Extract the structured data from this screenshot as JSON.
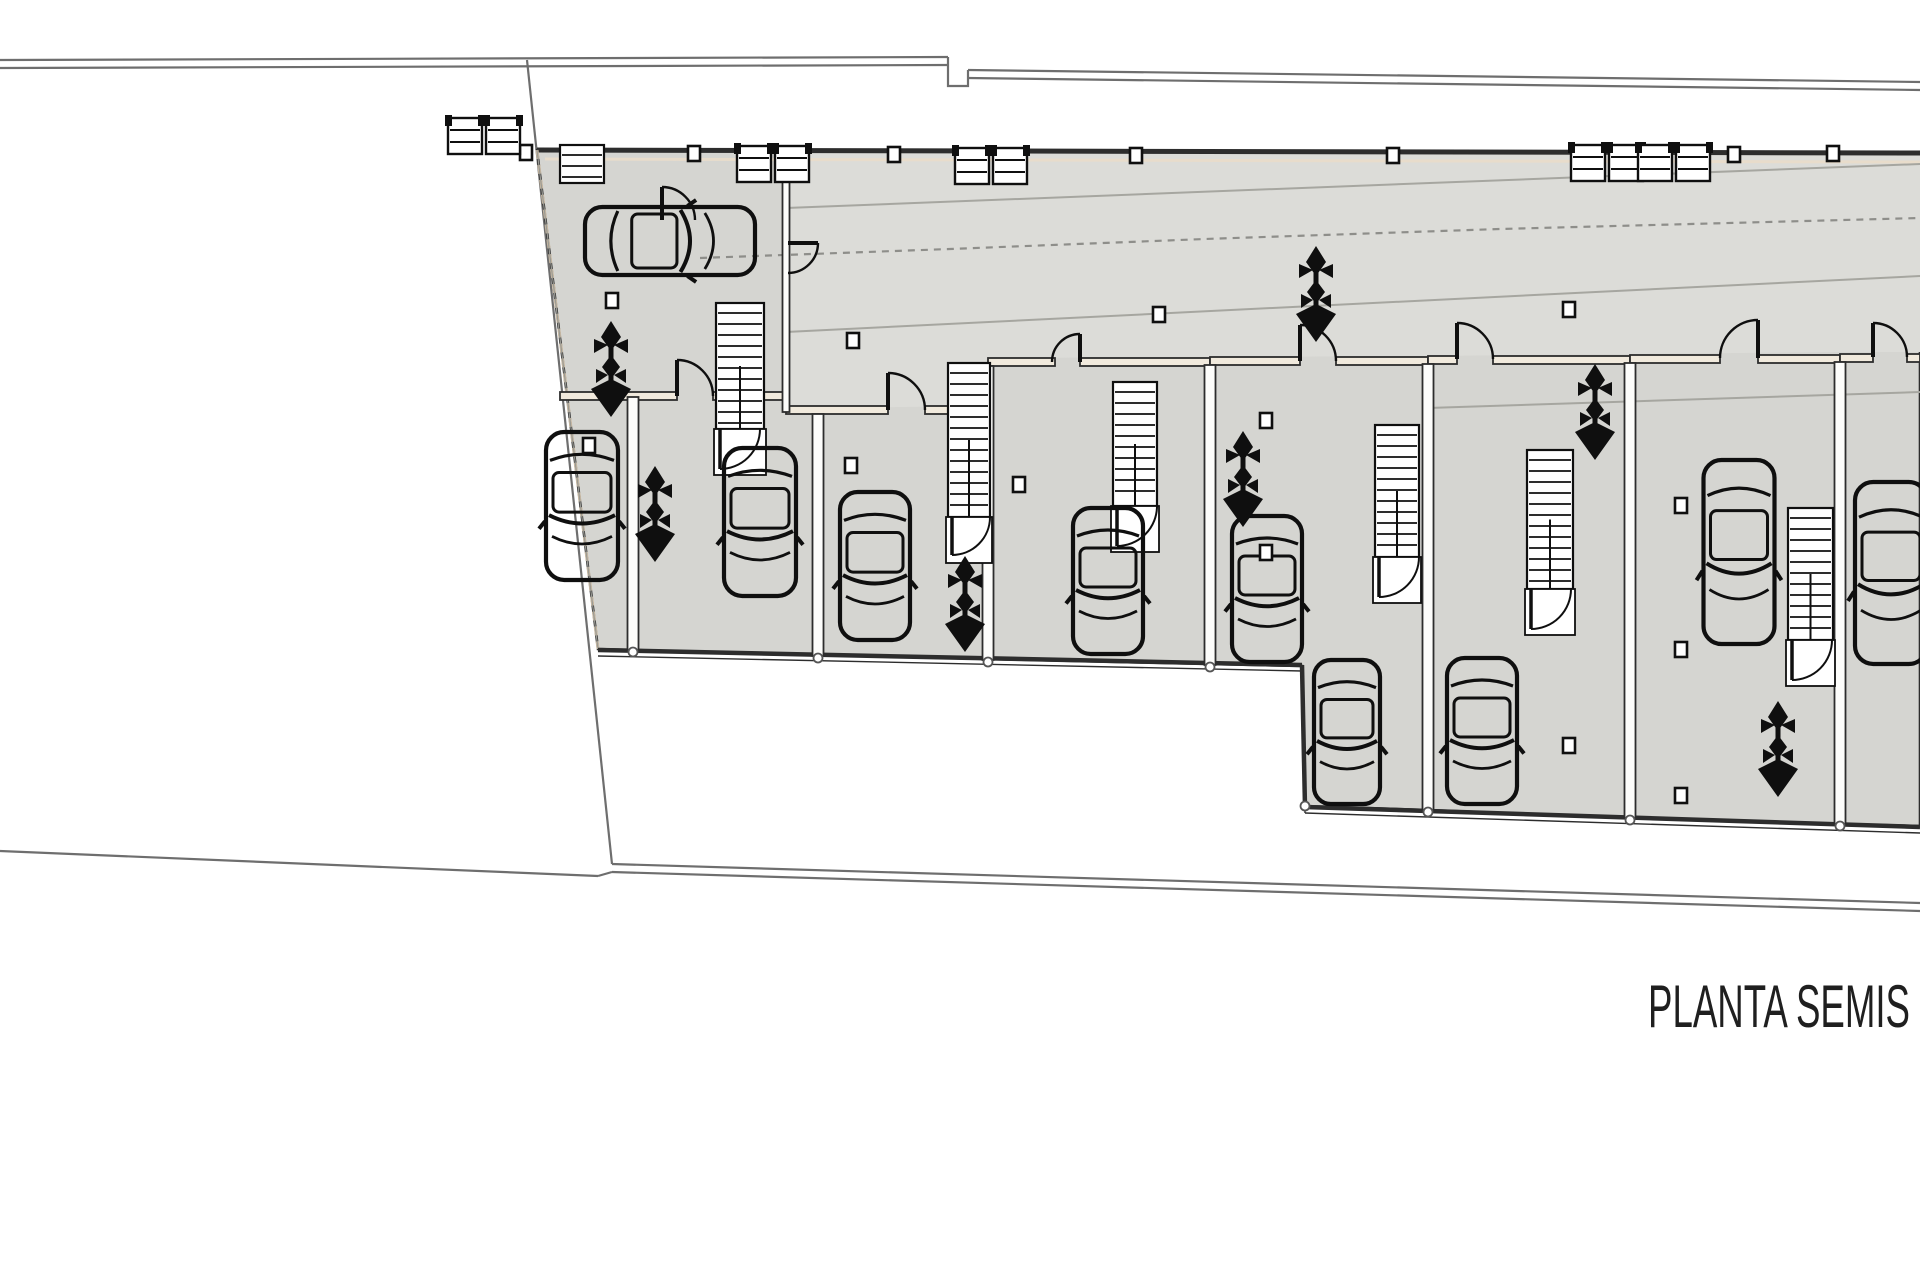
{
  "title": {
    "label": "PLANTA SEMIS",
    "x": 1648,
    "y": 1027,
    "font_size": 60,
    "text_length": 262
  },
  "colors": {
    "paper": "#ffffff",
    "floor": "#d5d5d1",
    "ramp_floor": "#dcdcd8",
    "wall_dark": "#2d2d2d",
    "symbol_ink": "#0f0f0f",
    "boundary": "#6e6e6e",
    "accent_beige": "#e8dccb",
    "wall_fill": "#f1eadd",
    "partition_fill": "#fdfdfb",
    "slope_line": "#a6a6a0",
    "dash_path": "#8e8e8a"
  },
  "site": {
    "lines": [
      {
        "name": "top-boundary-outer",
        "pts": [
          [
            0,
            60
          ],
          [
            948,
            57
          ]
        ]
      },
      {
        "name": "top-boundary-inner",
        "pts": [
          [
            0,
            68
          ],
          [
            948,
            65
          ]
        ]
      },
      {
        "name": "top-boundary-notch",
        "pts": [
          [
            948,
            57
          ],
          [
            948,
            86
          ],
          [
            968,
            86
          ],
          [
            968,
            70
          ]
        ]
      },
      {
        "name": "top-boundary-right-outer",
        "pts": [
          [
            968,
            70
          ],
          [
            1920,
            82
          ]
        ]
      },
      {
        "name": "top-boundary-right-inner",
        "pts": [
          [
            968,
            78
          ],
          [
            1920,
            90
          ]
        ]
      },
      {
        "name": "west-diagonal-boundary",
        "pts": [
          [
            527,
            60
          ],
          [
            612,
            864
          ]
        ]
      },
      {
        "name": "south-boundary-left",
        "pts": [
          [
            0,
            851
          ],
          [
            598,
            876
          ]
        ]
      },
      {
        "name": "south-boundary-jog",
        "pts": [
          [
            598,
            876
          ],
          [
            612,
            872
          ]
        ]
      },
      {
        "name": "south-boundary-right-outer",
        "pts": [
          [
            612,
            864
          ],
          [
            1920,
            903
          ]
        ]
      },
      {
        "name": "south-boundary-right-inner",
        "pts": [
          [
            612,
            872
          ],
          [
            1920,
            911
          ]
        ]
      }
    ]
  },
  "building": {
    "outline": [
      [
        537,
        150
      ],
      [
        1920,
        153
      ],
      [
        1920,
        826
      ],
      [
        1840,
        824
      ],
      [
        1630,
        818
      ],
      [
        1428,
        810
      ],
      [
        1305,
        806
      ],
      [
        1302,
        666
      ],
      [
        1210,
        664
      ],
      [
        988,
        659
      ],
      [
        818,
        655
      ],
      [
        633,
        650
      ],
      [
        598,
        649
      ]
    ],
    "ramp_area": [
      [
        786,
        153
      ],
      [
        1920,
        155
      ],
      [
        1920,
        352
      ],
      [
        1840,
        352
      ],
      [
        1630,
        354
      ],
      [
        1428,
        356
      ],
      [
        1210,
        357
      ],
      [
        988,
        358
      ],
      [
        988,
        406
      ],
      [
        818,
        408
      ],
      [
        786,
        410
      ]
    ],
    "top_wall": [
      [
        537,
        150
      ],
      [
        1920,
        153
      ]
    ],
    "top_wall_accent": [
      [
        545,
        159
      ],
      [
        1920,
        162
      ]
    ],
    "left_edge_dashed": [
      [
        537,
        150
      ],
      [
        598,
        649
      ]
    ],
    "bottom_walls": [
      {
        "pts": [
          [
            598,
            650
          ],
          [
            1302,
            665
          ]
        ]
      },
      {
        "pts": [
          [
            1302,
            665
          ],
          [
            1305,
            807
          ]
        ]
      },
      {
        "pts": [
          [
            1305,
            807
          ],
          [
            1920,
            827
          ]
        ]
      }
    ]
  },
  "walls": {
    "front_segments": [
      {
        "x": 560,
        "y": 392,
        "len": 117
      },
      {
        "x": 713,
        "y": 392,
        "len": 73
      },
      {
        "x": 786,
        "y": 406,
        "len": 102
      },
      {
        "x": 925,
        "y": 406,
        "len": 63
      },
      {
        "x": 988,
        "y": 358,
        "len": 67
      },
      {
        "x": 1080,
        "y": 358,
        "len": 130
      },
      {
        "x": 1210,
        "y": 357,
        "len": 90
      },
      {
        "x": 1336,
        "y": 357,
        "len": 92
      },
      {
        "x": 1428,
        "y": 356,
        "len": 29
      },
      {
        "x": 1493,
        "y": 356,
        "len": 137
      },
      {
        "x": 1630,
        "y": 355,
        "len": 90
      },
      {
        "x": 1758,
        "y": 355,
        "len": 82
      },
      {
        "x": 1840,
        "y": 354,
        "len": 33
      },
      {
        "x": 1907,
        "y": 354,
        "len": 13
      }
    ],
    "partitions": [
      {
        "x": 633,
        "y1": 397,
        "y2": 650,
        "w": 11
      },
      {
        "x": 818,
        "y1": 414,
        "y2": 656,
        "w": 11
      },
      {
        "x": 988,
        "y1": 366,
        "y2": 660,
        "w": 11
      },
      {
        "x": 1210,
        "y1": 365,
        "y2": 665,
        "w": 11
      },
      {
        "x": 1428,
        "y1": 364,
        "y2": 810,
        "w": 11
      },
      {
        "x": 1630,
        "y1": 363,
        "y2": 818,
        "w": 11
      },
      {
        "x": 1840,
        "y1": 362,
        "y2": 824,
        "w": 11
      },
      {
        "x": 786,
        "y1": 155,
        "y2": 412,
        "w": 7
      }
    ]
  },
  "ramp": {
    "slope_lines": [
      {
        "pts": [
          [
            786,
            208
          ],
          [
            1920,
            164
          ]
        ]
      },
      {
        "pts": [
          [
            786,
            332
          ],
          [
            1920,
            276
          ]
        ]
      },
      {
        "pts": [
          [
            1428,
            408
          ],
          [
            1920,
            392
          ]
        ]
      }
    ],
    "dashed_path": [
      [
        700,
        258
      ],
      [
        950,
        249
      ],
      [
        1205,
        239
      ],
      [
        1500,
        229
      ],
      [
        1920,
        218
      ]
    ]
  },
  "stairs": [
    {
      "x": 716,
      "y": 303,
      "w": 48,
      "h": 172,
      "door": true
    },
    {
      "x": 948,
      "y": 363,
      "w": 42,
      "h": 200,
      "door": true
    },
    {
      "x": 1113,
      "y": 382,
      "w": 44,
      "h": 170,
      "door": true
    },
    {
      "x": 1375,
      "y": 425,
      "w": 44,
      "h": 178,
      "door": true
    },
    {
      "x": 1527,
      "y": 450,
      "w": 46,
      "h": 185,
      "door": true
    },
    {
      "x": 1788,
      "y": 508,
      "w": 45,
      "h": 178,
      "door": true
    },
    {
      "x": 560,
      "y": 145,
      "w": 44,
      "h": 38,
      "door": false
    }
  ],
  "doors": [
    {
      "x": 677,
      "y": 396,
      "r": 36,
      "mode": "up-right"
    },
    {
      "x": 888,
      "y": 410,
      "r": 37,
      "mode": "up-right"
    },
    {
      "x": 1080,
      "y": 362,
      "r": 28,
      "mode": "up-left"
    },
    {
      "x": 1300,
      "y": 361,
      "r": 36,
      "mode": "up-right"
    },
    {
      "x": 1457,
      "y": 359,
      "r": 36,
      "mode": "up-right"
    },
    {
      "x": 1758,
      "y": 358,
      "r": 38,
      "mode": "up-left"
    },
    {
      "x": 1873,
      "y": 357,
      "r": 34,
      "mode": "up-right"
    },
    {
      "x": 788,
      "y": 243,
      "r": 30,
      "mode": "right-down"
    },
    {
      "x": 662,
      "y": 220,
      "r": 33,
      "mode": "up-right"
    }
  ],
  "cars": [
    {
      "cx": 670,
      "cy": 241,
      "len": 174,
      "wid": 72,
      "angle": 90
    },
    {
      "cx": 582,
      "cy": 506,
      "len": 152,
      "wid": 76,
      "angle": 180
    },
    {
      "cx": 760,
      "cy": 522,
      "len": 152,
      "wid": 76,
      "angle": 180
    },
    {
      "cx": 875,
      "cy": 566,
      "len": 152,
      "wid": 74,
      "angle": 180
    },
    {
      "cx": 1108,
      "cy": 581,
      "len": 150,
      "wid": 74,
      "angle": 180
    },
    {
      "cx": 1267,
      "cy": 589,
      "len": 150,
      "wid": 74,
      "angle": 180
    },
    {
      "cx": 1347,
      "cy": 732,
      "len": 148,
      "wid": 70,
      "angle": 180
    },
    {
      "cx": 1482,
      "cy": 731,
      "len": 150,
      "wid": 74,
      "angle": 180
    },
    {
      "cx": 1739,
      "cy": 552,
      "len": 188,
      "wid": 75,
      "angle": 180
    },
    {
      "cx": 1891,
      "cy": 573,
      "len": 186,
      "wid": 76,
      "angle": 180
    }
  ],
  "plants": [
    {
      "cx": 611,
      "cy": 375
    },
    {
      "cx": 655,
      "cy": 520
    },
    {
      "cx": 965,
      "cy": 610
    },
    {
      "cx": 1243,
      "cy": 485
    },
    {
      "cx": 1316,
      "cy": 300
    },
    {
      "cx": 1595,
      "cy": 418
    },
    {
      "cx": 1778,
      "cy": 755
    }
  ],
  "columns": [
    {
      "x": 520,
      "y": 145
    },
    {
      "x": 688,
      "y": 146
    },
    {
      "x": 888,
      "y": 147
    },
    {
      "x": 1130,
      "y": 148
    },
    {
      "x": 1387,
      "y": 148
    },
    {
      "x": 1728,
      "y": 147
    },
    {
      "x": 1827,
      "y": 146
    },
    {
      "x": 606,
      "y": 293
    },
    {
      "x": 583,
      "y": 438
    },
    {
      "x": 845,
      "y": 458
    },
    {
      "x": 847,
      "y": 333
    },
    {
      "x": 1013,
      "y": 477
    },
    {
      "x": 1153,
      "y": 307
    },
    {
      "x": 1260,
      "y": 413
    },
    {
      "x": 1260,
      "y": 545
    },
    {
      "x": 1563,
      "y": 302
    },
    {
      "x": 1563,
      "y": 738
    },
    {
      "x": 1675,
      "y": 498
    },
    {
      "x": 1675,
      "y": 642
    },
    {
      "x": 1675,
      "y": 788
    }
  ],
  "vents": [
    {
      "x": 448,
      "y": 118
    },
    {
      "x": 486,
      "y": 118
    },
    {
      "x": 737,
      "y": 146
    },
    {
      "x": 775,
      "y": 146
    },
    {
      "x": 955,
      "y": 148
    },
    {
      "x": 993,
      "y": 148
    },
    {
      "x": 1571,
      "y": 145
    },
    {
      "x": 1609,
      "y": 145
    },
    {
      "x": 1638,
      "y": 145
    },
    {
      "x": 1676,
      "y": 145
    }
  ],
  "junction_circles": [
    {
      "x": 633,
      "y": 652
    },
    {
      "x": 818,
      "y": 658
    },
    {
      "x": 988,
      "y": 662
    },
    {
      "x": 1210,
      "y": 667
    },
    {
      "x": 1305,
      "y": 806
    },
    {
      "x": 1428,
      "y": 812
    },
    {
      "x": 1630,
      "y": 820
    },
    {
      "x": 1840,
      "y": 826
    }
  ]
}
